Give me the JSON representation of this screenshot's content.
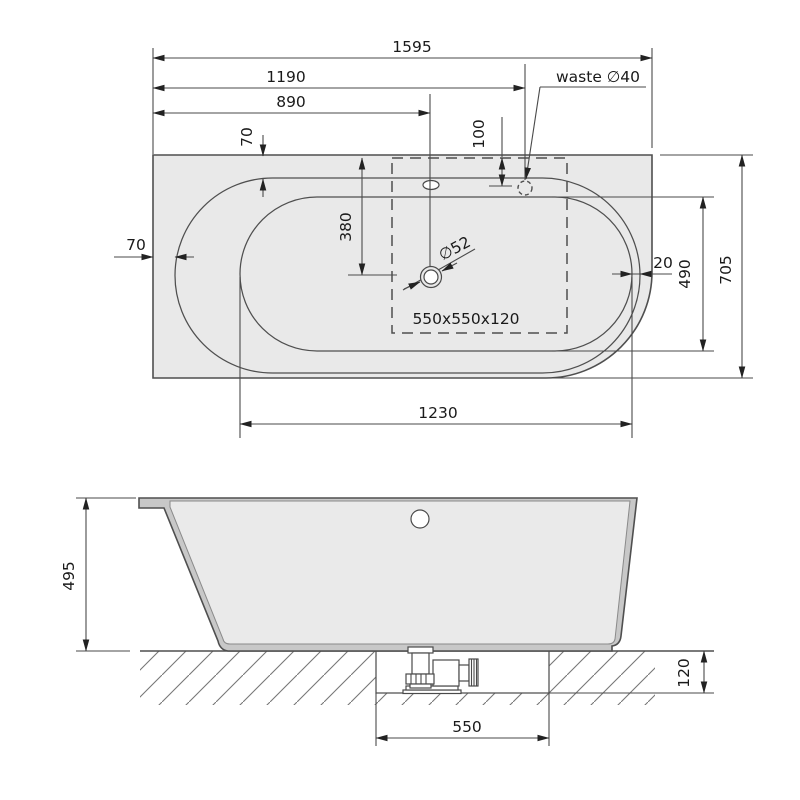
{
  "drawing": {
    "subject": "bathtub-installation-drawing",
    "views": [
      "top-view",
      "front-section-view"
    ]
  },
  "colors": {
    "background": "#ffffff",
    "body_fill": "#e9e9e9",
    "wall_fill": "#c8c8c8",
    "interior_fill": "#eaeaea",
    "line": "#4f4f4f",
    "text": "#1a1a1a"
  },
  "top_view": {
    "overall_length": "1595",
    "waste_offset": "1190",
    "drain_offset": "890",
    "rim_gap_top": "70",
    "waste_inset": "100",
    "drain_from_top": "380",
    "drain_diameter": "∅52",
    "rim_gap_left": "70",
    "rim_gap_right": "20",
    "basin_width": "490",
    "overall_width": "705",
    "basin_length": "1230",
    "frame_size": "550x550x120",
    "waste_label": "waste ∅40"
  },
  "side_view": {
    "height": "495",
    "recess_depth": "120",
    "recess_width": "550"
  }
}
